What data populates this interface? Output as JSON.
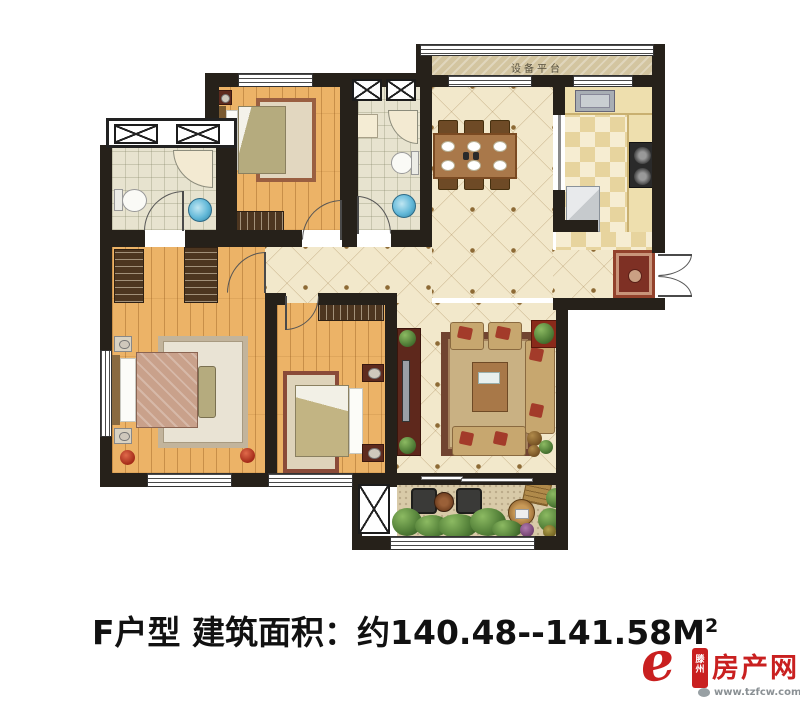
{
  "plan": {
    "platform_label": "设备平台"
  },
  "caption": {
    "prefix": "F户型 建筑面积：约140.48--141.58M",
    "sup": "2"
  },
  "logo": {
    "e_glyph": "e",
    "city_top": "滕",
    "city_bottom": "州",
    "name": "房产网",
    "url": "www.tzfcw.com.cn"
  },
  "colors": {
    "wall": "#26211a",
    "wood_floor": "#ecb367",
    "tile_floor": "#f2e8cb",
    "bath_tile": "#e7e3cf",
    "kitchen_floor": "#f6edd2",
    "balcony_floor": "#d8caa8",
    "platform": "#d3c5a0",
    "accent_red": "#c92020",
    "caption_text": "#111111",
    "url_gray": "#8a9094"
  }
}
